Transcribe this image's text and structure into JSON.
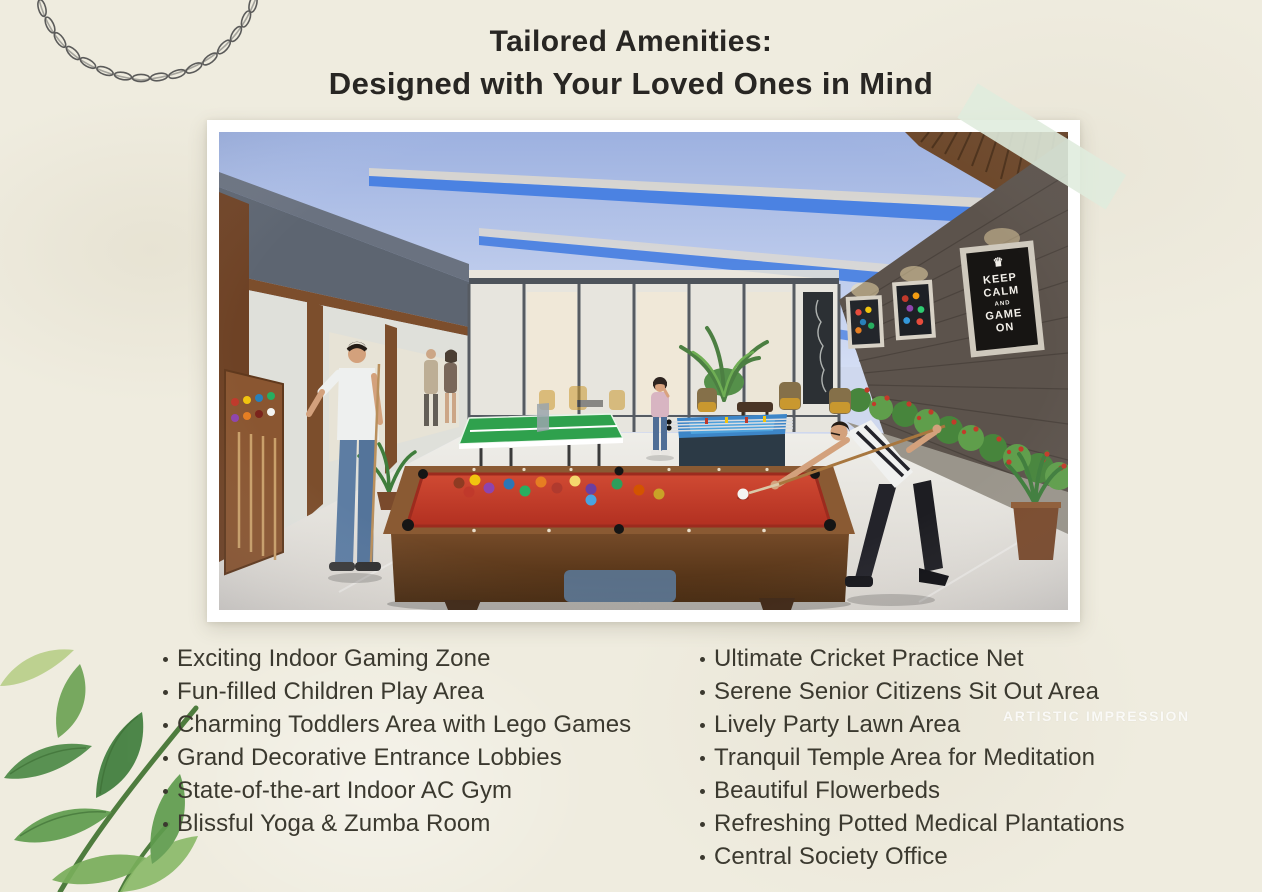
{
  "title": {
    "line1": "Tailored Amenities:",
    "line2": "Designed with Your Loved Ones in Mind"
  },
  "amenities": {
    "left": [
      "Exciting Indoor Gaming Zone",
      "Fun-filled Children Play Area",
      "Charming Toddlers Area with Lego Games",
      "Grand Decorative Entrance Lobbies",
      "State-of-the-art Indoor AC Gym",
      "Blissful Yoga & Zumba Room"
    ],
    "right": [
      "Ultimate Cricket Practice Net",
      "Serene Senior Citizens Sit Out Area",
      "Lively Party Lawn Area",
      "Tranquil Temple Area for Meditation",
      "Beautiful Flowerbeds",
      "Refreshing Potted Medical Plantations",
      "Central Society Office"
    ]
  },
  "watermark": "ARTISTIC IMPRESSION",
  "photo": {
    "poster": {
      "crown": "♛",
      "line1": "KEEP",
      "line2": "CALM",
      "line3": "AND",
      "line4": "GAME",
      "line5": "ON"
    }
  },
  "colors": {
    "background": "#efecdf",
    "title_text": "#282623",
    "list_text": "#3b392f",
    "photo_border": "#ffffff",
    "tape_green": "#dfecdd",
    "ceiling_blue": "#b9c7ea",
    "ceiling_light_band": "#4b82e2",
    "pool_cloth_red": "#c23a29",
    "table_tennis_green": "#2fa14d",
    "foosball_blue": "#3d86c8",
    "leaves_green": "#5f9c4e"
  }
}
